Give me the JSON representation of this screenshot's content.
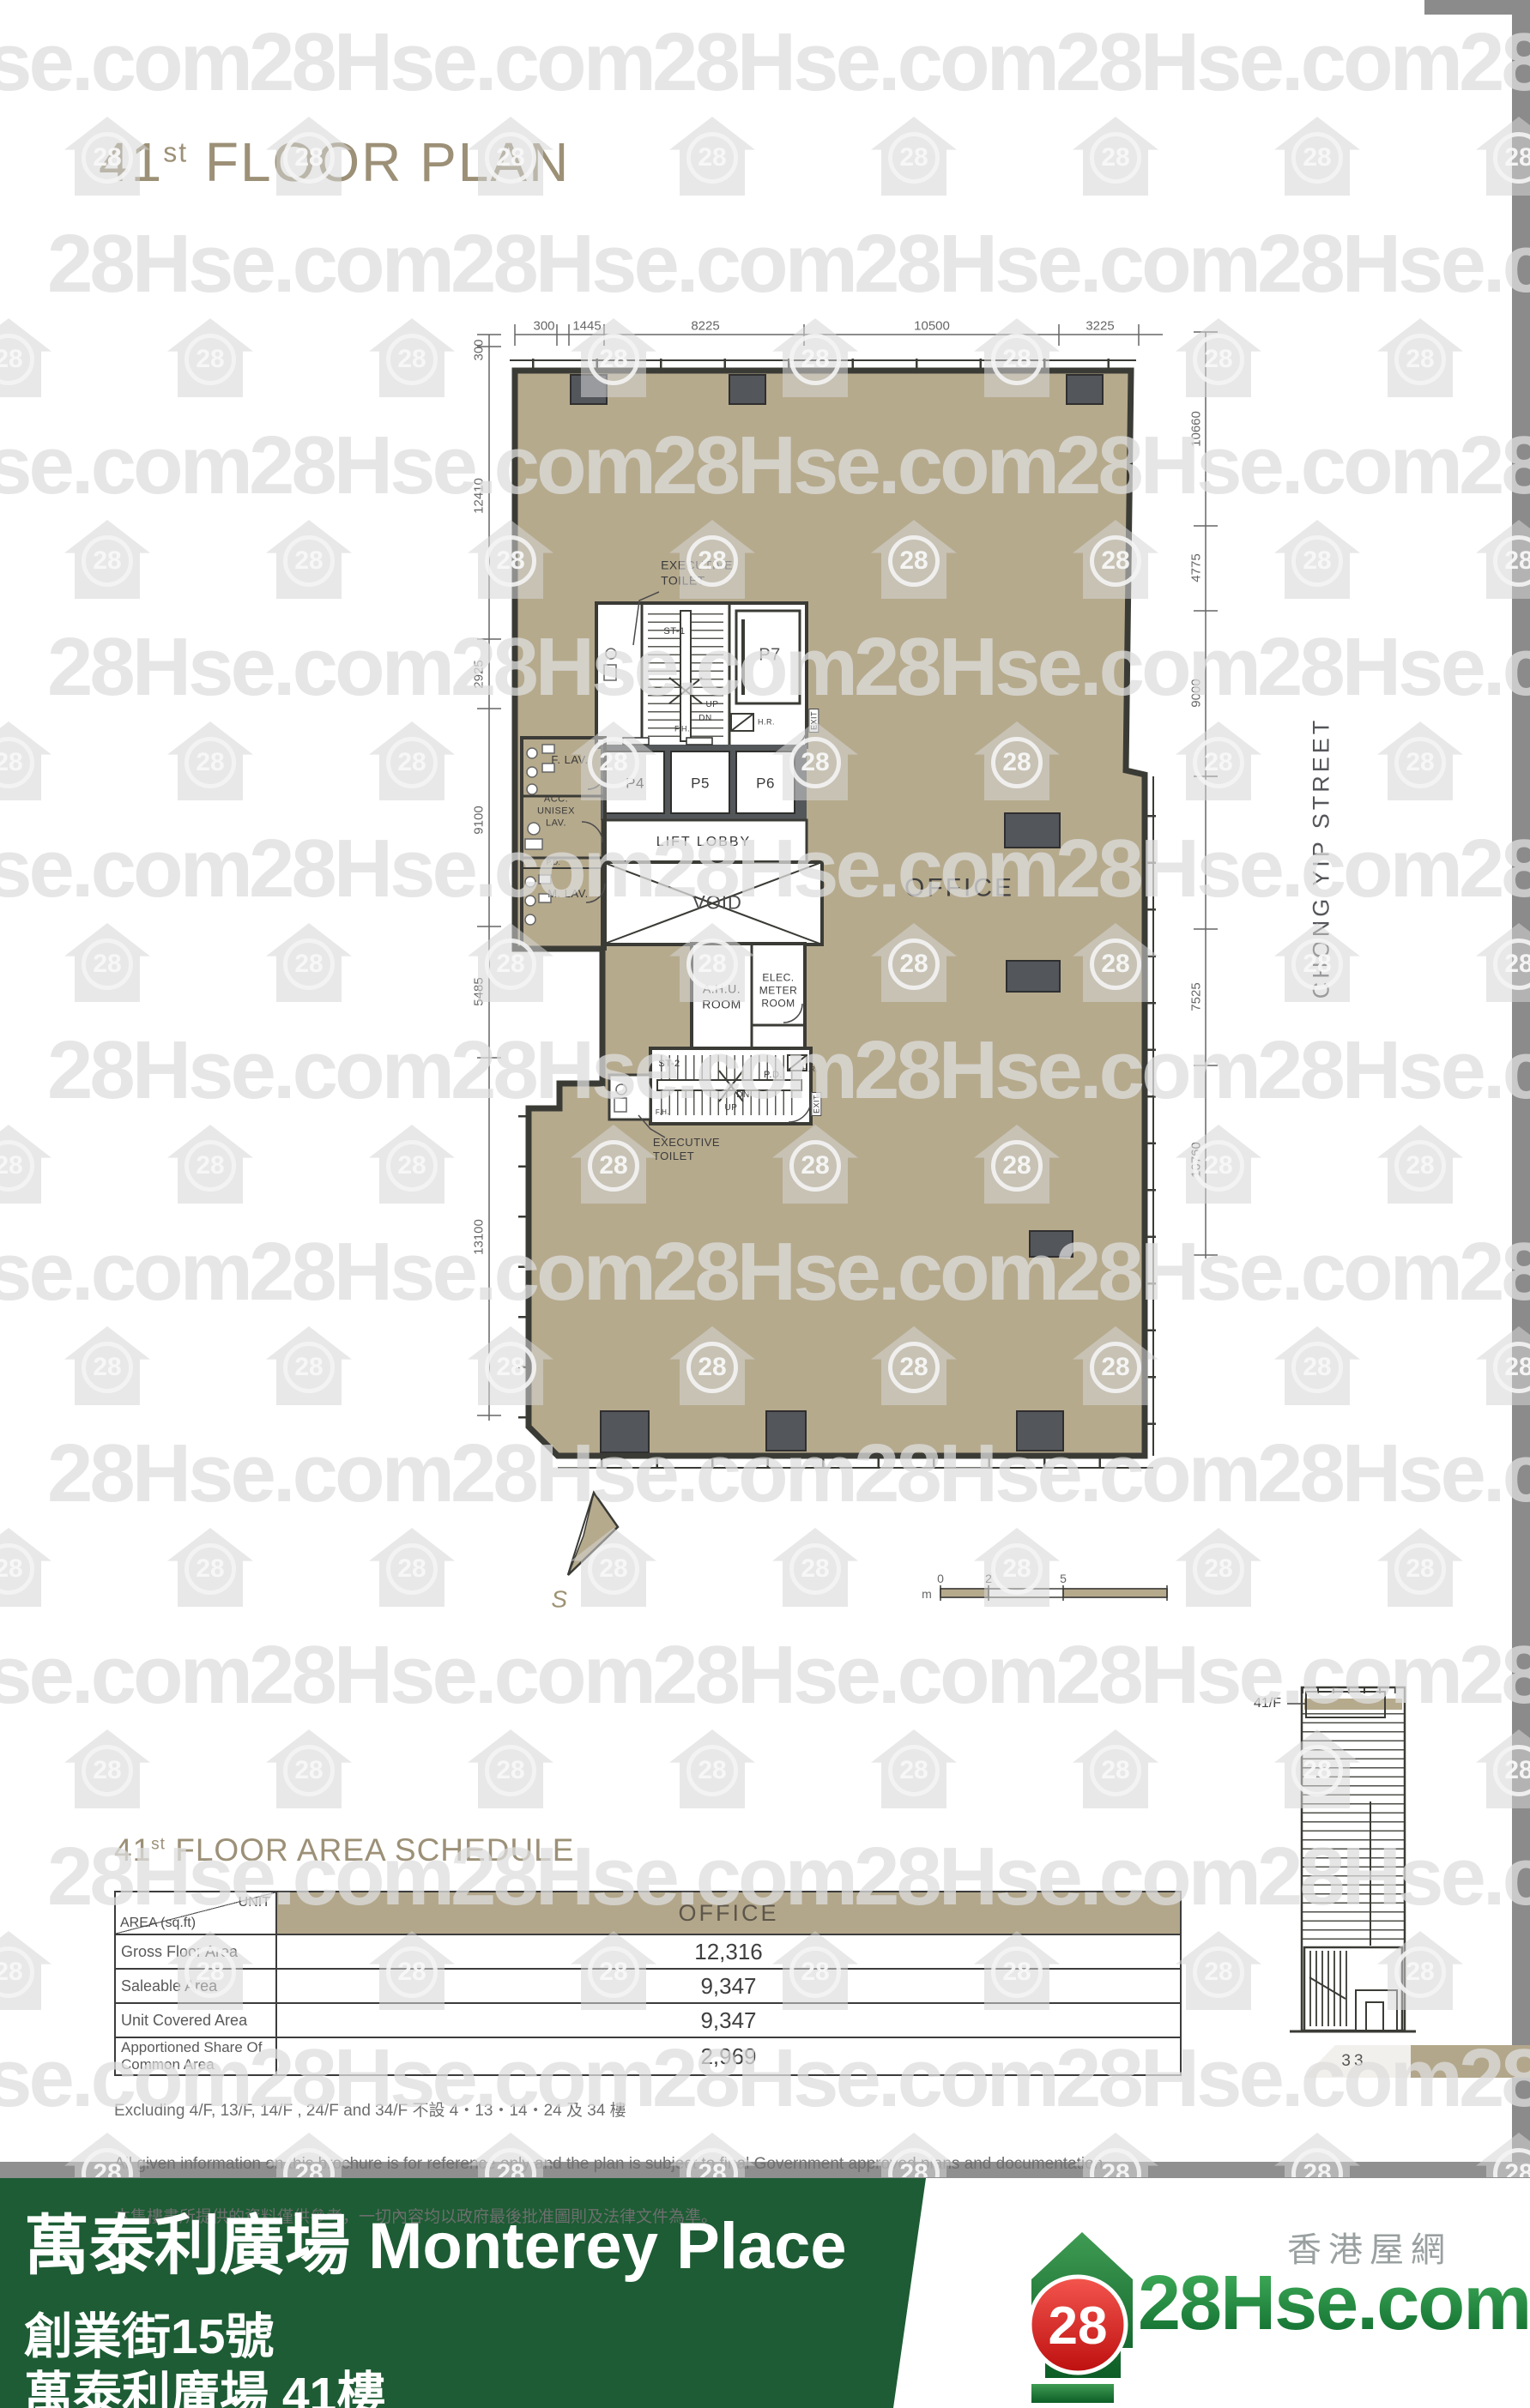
{
  "watermark": {
    "text": "28Hse.com",
    "badge": "28"
  },
  "title": {
    "num": "41",
    "sup": "st",
    "rest": " FLOOR PLAN"
  },
  "plan": {
    "dims_top": [
      "300",
      "1445",
      "8225",
      "10500",
      "3225"
    ],
    "dims_left": [
      "300",
      "12410",
      "2925",
      "9100",
      "5485",
      "13100"
    ],
    "dims_right": [
      "10660",
      "4775",
      "9000",
      "7525",
      "10760"
    ],
    "street": "CHONG YIP STREET",
    "labels": {
      "executive_toilet": "EXECUTIVE\nTOILET",
      "st1": "ST-1",
      "st2": "ST-2",
      "p4": "P4",
      "p5": "P5",
      "p6": "P6",
      "p7": "P7",
      "up": "UP",
      "dn": "DN",
      "hr": "H.R.",
      "fh": "F.H.",
      "pd": "P.D.",
      "exit": "EXIT",
      "f_lav": "F. LAV.",
      "acc_lav": "ACC.\nUNISEX\nLAV.",
      "m_lav": "M. LAV.",
      "lift_lobby": "LIFT LOBBY",
      "void": "VOID",
      "office": "OFFICE",
      "ahu": "A.H.U.\nROOM",
      "elec": "ELEC.\nMETER\nROOM"
    },
    "compass_label": "S",
    "scale_bar": {
      "unit": "m",
      "ticks": [
        "0",
        "2",
        "5"
      ]
    }
  },
  "schedule": {
    "heading": {
      "num": "41",
      "sup": "st",
      "rest": " FLOOR AREA SCHEDULE"
    },
    "header": {
      "corner_top": "UNIT",
      "corner_bottom": "AREA (sq.ft)",
      "column": "OFFICE"
    },
    "rows": [
      {
        "label": "Gross Floor Area",
        "value": "12,316"
      },
      {
        "label": "Saleable Area",
        "value": "9,347"
      },
      {
        "label": "Unit Covered Area",
        "value": "9,347"
      },
      {
        "label": "Apportioned Share Of\nCommon Area",
        "value": "2,969"
      }
    ]
  },
  "notes": [
    "Excluding 4/F, 13/F, 14/F , 24/F and 34/F  不設 4‧13‧14‧24 及 34 樓",
    "All given information on this brochure is for reference only and the plan is subject to final Government approved plans and documentation.",
    "本售樓書所提供的資料僅供參考，一切內容均以政府最後批准圖則及法律文件為準。"
  ],
  "elevation": {
    "floor_label": "41/F"
  },
  "page_number": "33",
  "banner": {
    "title": "萬泰利廣場 Monterey Place",
    "line2": "創業街15號",
    "line3": "萬泰利廣場 41樓"
  },
  "brand": {
    "cn": "香港屋網",
    "site": "28Hse.com",
    "badge": "28"
  },
  "colors": {
    "plan_fill": "#b6aa8d",
    "banner_green": "#1d5c34",
    "accent_tan": "#b3a78b"
  }
}
